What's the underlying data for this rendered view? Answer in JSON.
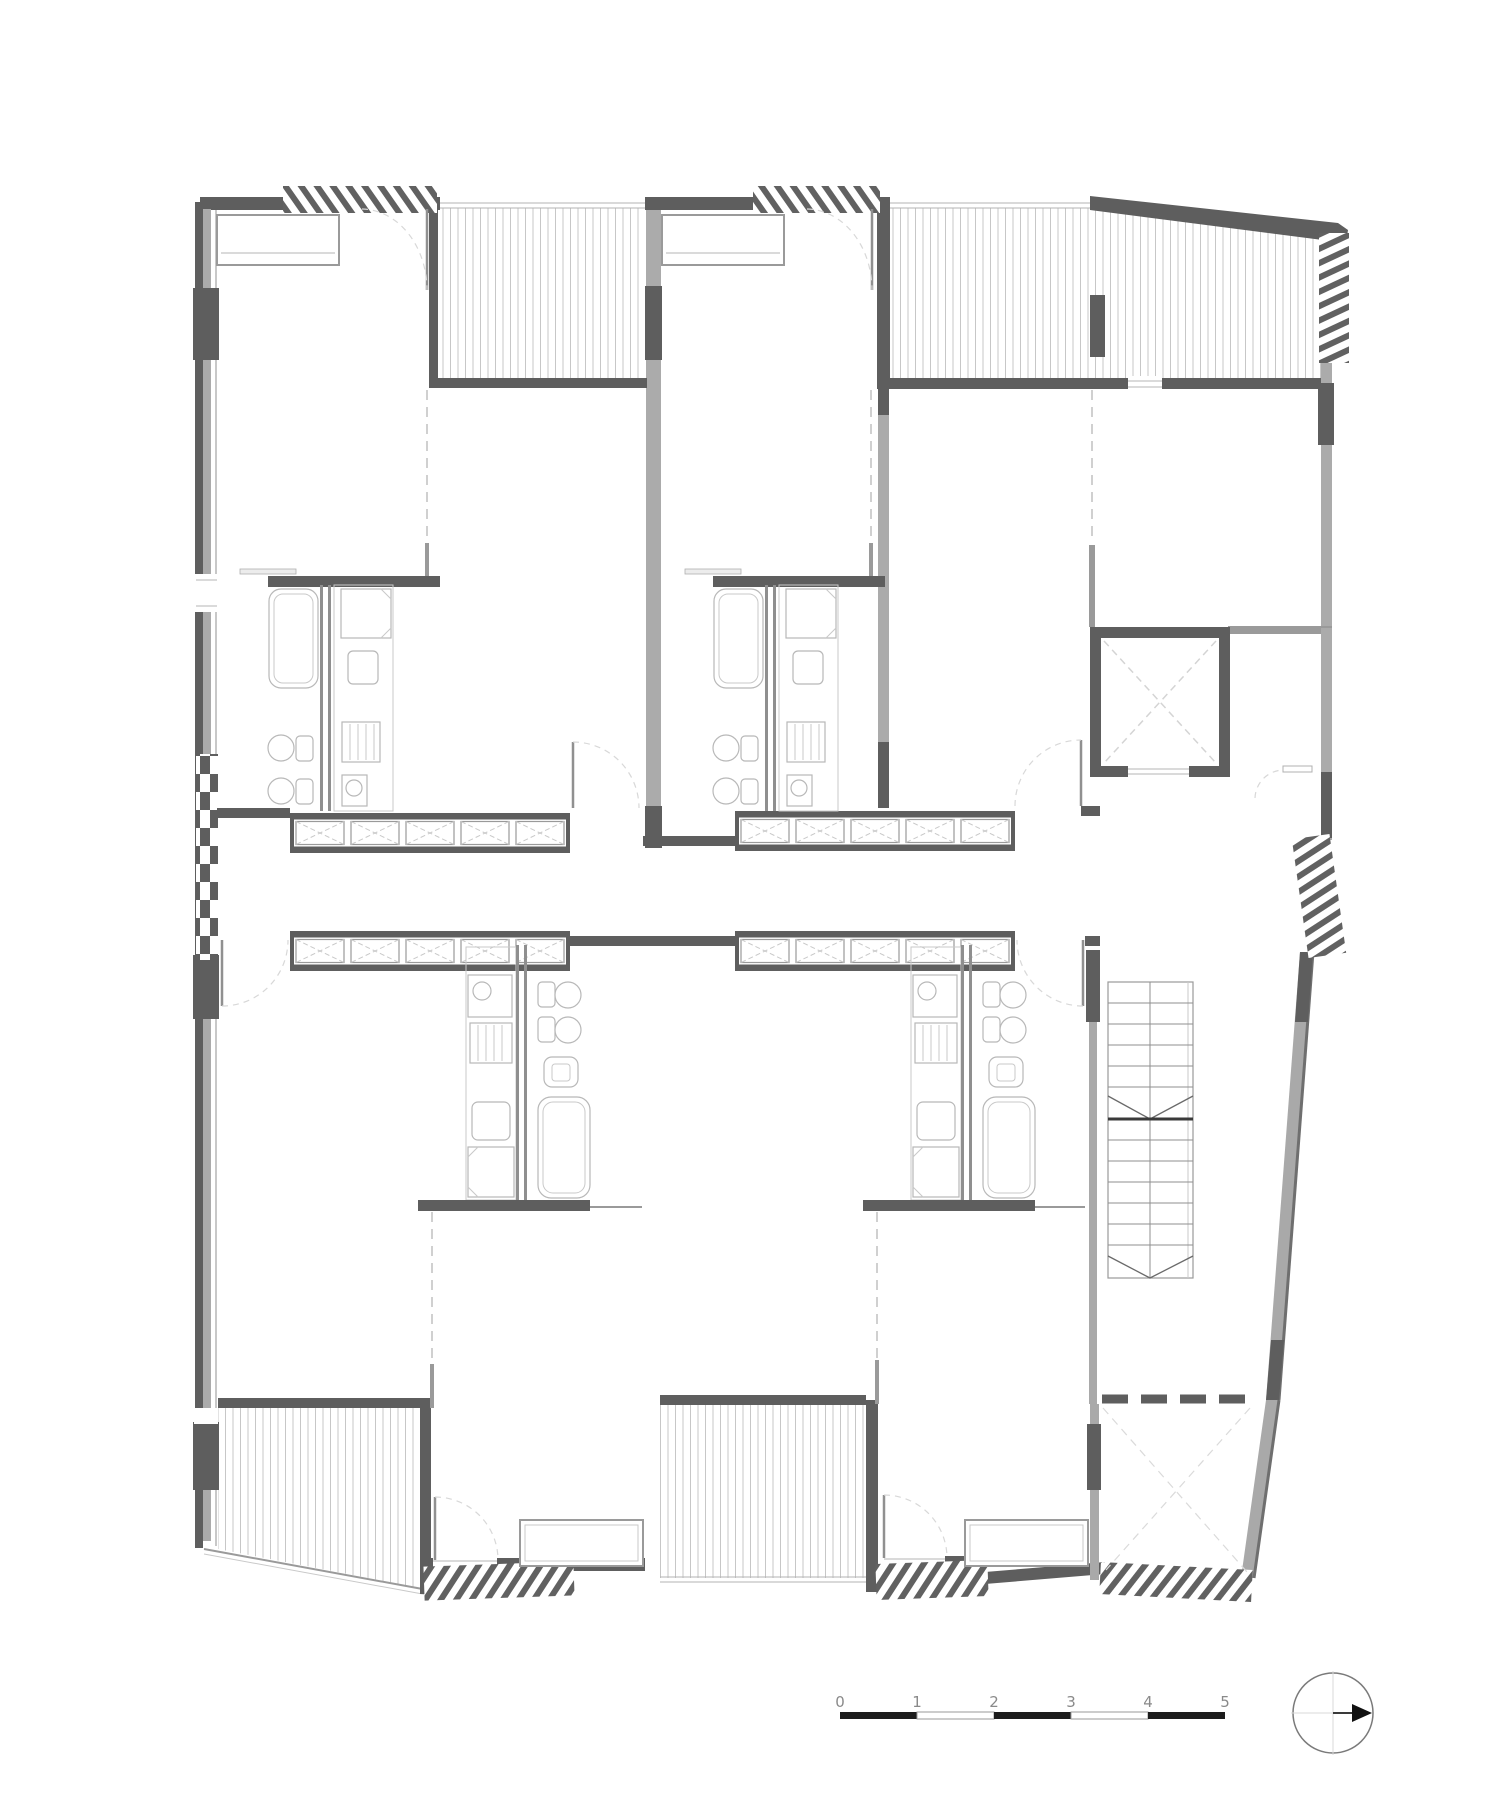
{
  "document": {
    "kind": "architectural-floor-plan",
    "background": "#ffffff",
    "visible_text": "scale bar numerals only"
  },
  "palette": {
    "wall_dark": "#5e5e5e",
    "wall_light": "#a9a9a9",
    "thin_line": "#b5b5b5",
    "hatch_line": "#c7c7c7",
    "dash_line": "#d8d8d8",
    "fixture_line": "#b8b8b8",
    "scale_solid": "#1c1c1c",
    "scale_text": "#8a8a8a"
  },
  "scale_bar": {
    "labels": [
      "0",
      "1",
      "2",
      "3",
      "4",
      "5"
    ],
    "segments": [
      "solid",
      "open",
      "solid",
      "open",
      "solid"
    ]
  },
  "north_arrow": {
    "style": "circle with crosshair",
    "pointing": "right"
  },
  "elements": [
    "unit-1-top-left",
    "unit-2-top-middle",
    "unit-3-bottom-left",
    "unit-4-bottom-middle",
    "deck-unit-1",
    "deck-common-top-right",
    "deck-unit-3",
    "deck-unit-4",
    "terrace-south-east",
    "corridor-central",
    "window-array-x4",
    "elevator-shaft",
    "stair-two-flights",
    "louver-screens-x7",
    "bathroom-tub-toilet-sink-x4",
    "kitchen-counter-x4",
    "entry-closets",
    "door-swings"
  ]
}
